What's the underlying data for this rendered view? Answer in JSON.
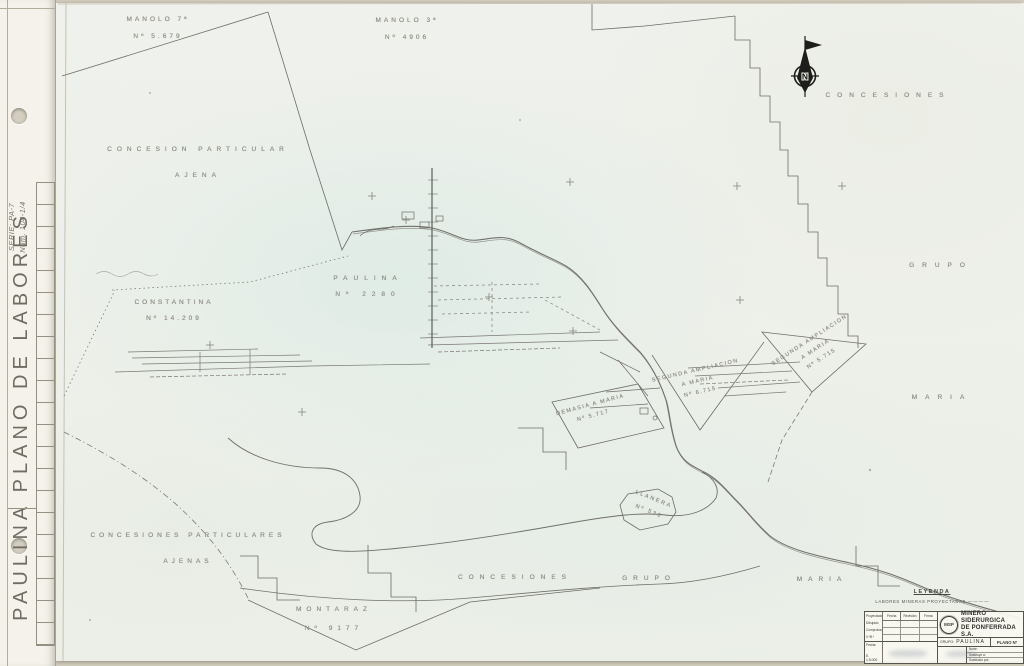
{
  "binder": {
    "vertical_title": "PAULINA PLANO DE LABORES",
    "handwriting_line1": "SERIE: PA-7",
    "handwriting_line2": "Núm. 104-1/4"
  },
  "north": {
    "letter": "N"
  },
  "map": {
    "labels": [
      {
        "n": "label-manolo-7",
        "lines": [
          "MANOLO 7ª",
          "Nº 5.679"
        ],
        "x": 158,
        "y": 28,
        "ls": 3,
        "fs": 6.5,
        "lh": 17
      },
      {
        "n": "label-manolo-3",
        "lines": [
          "MANOLO 3ª",
          "Nº 4906"
        ],
        "x": 407,
        "y": 29,
        "ls": 3,
        "fs": 6.5,
        "lh": 17
      },
      {
        "n": "label-concesiones-top-right",
        "lines": [
          "CONCESIONES"
        ],
        "x": 888,
        "y": 96,
        "ls": 7,
        "fs": 6.5,
        "lh": 10
      },
      {
        "n": "label-concesion-particular-ajena",
        "lines": [
          "CONCESION  PARTICULAR",
          "AJENA"
        ],
        "x": 198,
        "y": 163,
        "ls": 5,
        "fs": 6.5,
        "lh": 26
      },
      {
        "n": "label-paulina",
        "lines": [
          "PAULINA",
          "Nº 2280"
        ],
        "x": 368,
        "y": 287,
        "ls": 6,
        "fs": 6.5,
        "lh": 16
      },
      {
        "n": "label-constantina",
        "lines": [
          "CONSTANTINA",
          "Nº 14.209"
        ],
        "x": 174,
        "y": 311,
        "ls": 3,
        "fs": 6.5,
        "lh": 16
      },
      {
        "n": "label-grupo-right",
        "lines": [
          "GRUPO"
        ],
        "x": 941,
        "y": 266,
        "ls": 8,
        "fs": 6.5,
        "lh": 10
      },
      {
        "n": "label-maria-right",
        "lines": [
          "MARIA"
        ],
        "x": 942,
        "y": 398,
        "ls": 8,
        "fs": 6.5,
        "lh": 10
      },
      {
        "n": "label-segunda-ampliacion-5715",
        "lines": [
          "SEGUNDA AMPLIACION",
          "A  MARIA",
          "Nº 5.715"
        ],
        "x": 816,
        "y": 350,
        "rot": -33,
        "ls": 1.5,
        "fs": 5.5,
        "lh": 11
      },
      {
        "n": "label-segunda-ampliacion-6715",
        "lines": [
          "SEGUNDA AMPLIACION",
          "A  MARIA",
          "Nº 6.715"
        ],
        "x": 698,
        "y": 382,
        "rot": -13,
        "ls": 1.5,
        "fs": 5.5,
        "lh": 11
      },
      {
        "n": "label-demasia-a-maria",
        "lines": [
          "DEMASIA  A  MARIA",
          "Nº 5.717"
        ],
        "x": 592,
        "y": 411,
        "rot": -15,
        "ls": 1.5,
        "fs": 5.5,
        "lh": 11
      },
      {
        "n": "label-llanera",
        "lines": [
          "LLANERA",
          "Nº 530"
        ],
        "x": 651,
        "y": 506,
        "rot": 22,
        "ls": 2,
        "fs": 5.5,
        "lh": 13
      },
      {
        "n": "label-concesiones-particulares-ajenas",
        "lines": [
          "CONCESIONES  PARTICULARES",
          "AJENAS"
        ],
        "x": 188,
        "y": 549,
        "ls": 4,
        "fs": 6.5,
        "lh": 26
      },
      {
        "n": "label-concesiones-bottom",
        "lines": [
          "CONCESIONES"
        ],
        "x": 515,
        "y": 578,
        "ls": 6,
        "fs": 6.5,
        "lh": 10
      },
      {
        "n": "label-grupo-bottom",
        "lines": [
          "GRUPO"
        ],
        "x": 649,
        "y": 579,
        "ls": 6,
        "fs": 6.5,
        "lh": 10
      },
      {
        "n": "label-maria-bottom",
        "lines": [
          "MARIA"
        ],
        "x": 822,
        "y": 580,
        "ls": 6,
        "fs": 6.5,
        "lh": 10
      },
      {
        "n": "label-montaraz",
        "lines": [
          "MONTARAZ",
          "Nº 9177"
        ],
        "x": 334,
        "y": 619,
        "ls": 5,
        "fs": 6.5,
        "lh": 19
      }
    ]
  },
  "legend": {
    "title": "LEYENDA",
    "item": "LABORES MINERAS PROYECTADAS",
    "symbol": "— — — —"
  },
  "title_block": {
    "company": [
      "MINERO SIDERURGICA",
      "DE PONFERRADA S.A."
    ],
    "logo": "MSP",
    "grupo_label": "GRUPO:",
    "grupo_value": "PAULINA",
    "plano_label": "PLANO Nº",
    "headers": [
      "Fecha",
      "Revisión",
      "Firma"
    ],
    "row_labels": "Proyectado Dibujado Comprobado V.ºB.º",
    "fecha_label": "Fecha:",
    "escala": "E. 1:5.000",
    "meta": [
      "Norte:",
      "Sustituye a:",
      "Sustituido por:"
    ]
  }
}
